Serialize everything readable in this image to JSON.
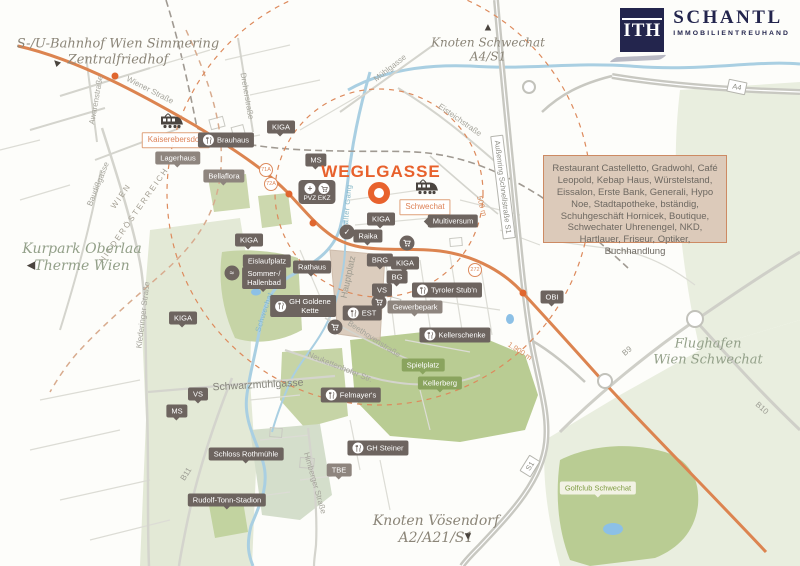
{
  "logo": {
    "mark": "ITH",
    "name": "SCHANTL",
    "subtitle": "IMMOBILIENTREUHAND",
    "brand_color": "#23254d"
  },
  "title_label": {
    "text": "WEGLGASSE",
    "color": "#e8612c"
  },
  "info_box": {
    "text": "Restaurant Castelletto, Gradwohl, Café Leopold, Kebap Haus, Würstelstand, Eissalon, Erste Bank, Generali, Hypo Noe, Stadtapotheke, bständig, Schuhgeschäft Hornicek, Boutique, Schwechater Uhrenengel, NKD, Hartlauer, Friseur, Optiker, Buchhandlung",
    "bg": "#dccaba",
    "border": "#cd8a63"
  },
  "colors": {
    "accent_orange": "#e8612c",
    "road_orange": "#dc8450",
    "badge_dark": "#6d645f",
    "badge_green": "#8aa45e",
    "river_blue": "#a9cfe2",
    "park_green": "#ccd8ae"
  },
  "map": {
    "marker": {
      "x": 379,
      "y": 193
    },
    "area_labels": [
      {
        "name": "label-bahnhof-simmering",
        "lines": [
          "S-/U-Bahnhof Wien Simmering",
          "Zentralfriedhof"
        ],
        "x": 118,
        "y": 52,
        "size": 13,
        "color": "#8b8578",
        "arrow": {
          "dir": "up-left",
          "x": 57,
          "y": 63
        }
      },
      {
        "name": "label-knoten-schwechat",
        "lines": [
          "Knoten Schwechat",
          "A4/S1"
        ],
        "x": 488,
        "y": 50,
        "size": 12,
        "color": "#8b8578",
        "arrow": {
          "dir": "up",
          "x": 488,
          "y": 28
        }
      },
      {
        "name": "label-kurpark-oberlaa",
        "lines": [
          "Kurpark Oberlaa",
          "Therme Wien"
        ],
        "x": 82,
        "y": 258,
        "size": 14,
        "color": "#93a089",
        "arrow": {
          "dir": "left",
          "x": 31,
          "y": 266
        }
      },
      {
        "name": "label-flughafen",
        "lines": [
          "Flughafen",
          "Wien Schwechat"
        ],
        "x": 708,
        "y": 352,
        "size": 13,
        "color": "#93a089"
      },
      {
        "name": "label-knoten-voesendorf",
        "lines": [
          "Knoten Vösendorf",
          "A2/A21/S1"
        ],
        "x": 436,
        "y": 530,
        "size": 14,
        "color": "#8b8578",
        "arrow": {
          "dir": "down",
          "x": 468,
          "y": 537
        }
      }
    ],
    "street_labels": [
      {
        "text": "Wiener Straße",
        "x": 150,
        "y": 90,
        "rot": 27
      },
      {
        "text": "Awarenstraße",
        "x": 96,
        "y": 100,
        "rot": -80
      },
      {
        "text": "Baudißgasse",
        "x": 98,
        "y": 184,
        "rot": -68
      },
      {
        "text": "Dreherstraße",
        "x": 247,
        "y": 96,
        "rot": 80
      },
      {
        "text": "Mühlgasse",
        "x": 390,
        "y": 68,
        "rot": -38
      },
      {
        "text": "Eisteichstraße",
        "x": 460,
        "y": 120,
        "rot": 35
      },
      {
        "text": "Klederinger Straße",
        "x": 143,
        "y": 315,
        "rot": -83
      },
      {
        "text": "Schwarzmühlgasse",
        "x": 258,
        "y": 385,
        "rot": -3,
        "size": 10.5,
        "color": "#84837a"
      },
      {
        "text": "Neukettenhofer Str.",
        "x": 340,
        "y": 367,
        "rot": 22
      },
      {
        "text": "Beethovenstraße",
        "x": 374,
        "y": 339,
        "rot": 33
      },
      {
        "text": "Himberger Straße",
        "x": 315,
        "y": 483,
        "rot": 74
      },
      {
        "text": "Hauptplatz",
        "x": 348,
        "y": 277,
        "rot": -78,
        "size": 9,
        "color": "#9b998e"
      }
    ],
    "water_labels": [
      {
        "name": "river-label-kalter-gang",
        "text": "Kalter Gang",
        "x": 347,
        "y": 207,
        "rot": -85
      },
      {
        "name": "river-label-schwechat",
        "text": "Schwechat",
        "x": 264,
        "y": 312,
        "rot": -72
      }
    ],
    "border_labels": [
      {
        "text": "WIEN",
        "x": 121,
        "y": 196,
        "rot": -55
      },
      {
        "text": "NIEDERÖSTERREICH",
        "x": 134,
        "y": 215,
        "rot": -55
      }
    ],
    "shields": [
      {
        "name": "shield-a4",
        "text": "A4",
        "x": 737,
        "y": 87,
        "rot": 12,
        "boxed": true
      },
      {
        "name": "shield-s1",
        "text": "S1",
        "x": 530,
        "y": 466,
        "rot": -58,
        "boxed": true
      },
      {
        "name": "shield-aussenring-s1",
        "text": "Außenring Schnellstraße S1",
        "x": 503,
        "y": 187,
        "rot": 83,
        "boxed": true
      },
      {
        "name": "road-b9",
        "text": "B9",
        "x": 627,
        "y": 351,
        "rot": -40,
        "boxed": false
      },
      {
        "name": "road-b10",
        "text": "B10",
        "x": 762,
        "y": 408,
        "rot": 42,
        "boxed": false
      },
      {
        "name": "road-b11",
        "text": "B11",
        "x": 186,
        "y": 474,
        "rot": -58,
        "boxed": false
      }
    ],
    "distance_labels": [
      {
        "text": "500 m",
        "x": 482,
        "y": 206,
        "rot": 75
      },
      {
        "text": "1.900 m",
        "x": 520,
        "y": 351,
        "rot": 33
      }
    ],
    "bus_stops": [
      {
        "text": "71A",
        "x": 266,
        "y": 170
      },
      {
        "text": "72A",
        "x": 271,
        "y": 184
      },
      {
        "text": "272",
        "x": 475,
        "y": 270
      }
    ],
    "badges": [
      {
        "name": "badge-kaiserebersdorf",
        "label": "Kaiserebersdorf",
        "type": "orange",
        "x": 176,
        "y": 140
      },
      {
        "name": "badge-schwechat",
        "label": "Schwechat",
        "type": "orange",
        "x": 425,
        "y": 207
      },
      {
        "name": "badge-brauhaus",
        "label": "Brauhaus",
        "type": "dark",
        "icon": "fork",
        "x": 226,
        "y": 140
      },
      {
        "name": "badge-lagerhaus",
        "label": "Lagerhaus",
        "type": "medium",
        "pointer": true,
        "x": 178,
        "y": 158
      },
      {
        "name": "badge-bellaflora",
        "label": "Bellaflora",
        "type": "medium",
        "pointer": true,
        "x": 224,
        "y": 176
      },
      {
        "name": "badge-kiga-1",
        "label": "KIGA",
        "type": "dark",
        "pointer": true,
        "x": 281,
        "y": 127
      },
      {
        "name": "badge-ms-1",
        "label": "MS",
        "type": "dark",
        "pointer": true,
        "x": 316,
        "y": 160
      },
      {
        "name": "badge-pvz-ekz",
        "label": "PVZ EKZ",
        "type": "plaza",
        "x": 317,
        "y": 192
      },
      {
        "name": "badge-kiga-2",
        "label": "KIGA",
        "type": "dark",
        "pointer": true,
        "x": 381,
        "y": 219
      },
      {
        "name": "badge-raika",
        "label": "Raika",
        "type": "dark",
        "pointer": true,
        "x": 368,
        "y": 236
      },
      {
        "name": "badge-multiversum",
        "label": "Multiversum",
        "type": "dark",
        "arrowLeft": true,
        "x": 453,
        "y": 221
      },
      {
        "name": "badge-kiga-3",
        "label": "KIGA",
        "type": "dark",
        "pointer": true,
        "x": 249,
        "y": 240
      },
      {
        "name": "badge-eislaufplatz",
        "label": "Eislaufplatz",
        "type": "dark",
        "pointer": true,
        "x": 267,
        "y": 261
      },
      {
        "name": "badge-sommer-hallenbad",
        "lines": [
          "Sommer-/",
          "Hallenbad"
        ],
        "type": "dark",
        "pointer": true,
        "x": 264,
        "y": 278
      },
      {
        "name": "badge-rathaus",
        "label": "Rathaus",
        "type": "dark",
        "pointer": true,
        "x": 312,
        "y": 267
      },
      {
        "name": "badge-gh-goldene-kette",
        "lines": [
          "GH Goldene",
          "Kette"
        ],
        "type": "dark",
        "icon": "fork",
        "x": 303,
        "y": 306
      },
      {
        "name": "badge-kiga-4",
        "label": "KIGA",
        "type": "dark",
        "pointer": true,
        "x": 183,
        "y": 318
      },
      {
        "name": "badge-brg",
        "label": "BRG",
        "type": "dark",
        "pointer": true,
        "x": 380,
        "y": 260
      },
      {
        "name": "badge-kiga-5",
        "label": "KIGA",
        "type": "dark",
        "pointer": true,
        "x": 405,
        "y": 263
      },
      {
        "name": "badge-bg",
        "label": "BG",
        "type": "dark",
        "pointer": true,
        "x": 397,
        "y": 277
      },
      {
        "name": "badge-vs-1",
        "label": "VS",
        "type": "dark",
        "pointer": true,
        "x": 382,
        "y": 290
      },
      {
        "name": "badge-tyroler-stubn",
        "label": "Tyroler Stub'n",
        "type": "dark",
        "icon": "fork",
        "x": 447,
        "y": 290
      },
      {
        "name": "badge-gewerbepark",
        "label": "Gewerbepark",
        "type": "medium",
        "pointer": true,
        "x": 415,
        "y": 307
      },
      {
        "name": "badge-est",
        "label": "EST",
        "type": "dark",
        "icon": "fork",
        "x": 362,
        "y": 313
      },
      {
        "name": "badge-kellerschenke",
        "label": "Kellerschenke",
        "type": "dark",
        "icon": "fork",
        "x": 455,
        "y": 335
      },
      {
        "name": "badge-spielplatz",
        "label": "Spielplatz",
        "type": "green",
        "pointer": true,
        "x": 423,
        "y": 365
      },
      {
        "name": "badge-kellerberg",
        "label": "Kellerberg",
        "type": "green",
        "pointer": true,
        "x": 440,
        "y": 383
      },
      {
        "name": "badge-felmayers",
        "label": "Felmayer's",
        "type": "dark",
        "icon": "fork",
        "x": 351,
        "y": 395
      },
      {
        "name": "badge-gh-steiner",
        "label": "GH Steiner",
        "type": "dark",
        "icon": "fork",
        "x": 378,
        "y": 448
      },
      {
        "name": "badge-vs-2",
        "label": "VS",
        "type": "dark",
        "pointer": true,
        "x": 198,
        "y": 394
      },
      {
        "name": "badge-ms-2",
        "label": "MS",
        "type": "dark",
        "pointer": true,
        "x": 177,
        "y": 411
      },
      {
        "name": "badge-schloss-rothmuehle",
        "label": "Schloss Rothmühle",
        "type": "dark",
        "pointer": true,
        "x": 246,
        "y": 454
      },
      {
        "name": "badge-rudolf-tonn-stadion",
        "label": "Rudolf-Tonn-Stadion",
        "type": "dark",
        "pointer": true,
        "x": 227,
        "y": 500
      },
      {
        "name": "badge-tbe",
        "label": "TBE",
        "type": "medium",
        "pointer": true,
        "x": 339,
        "y": 470
      },
      {
        "name": "badge-obi",
        "label": "OBI",
        "type": "dark",
        "pointer": true,
        "x": 552,
        "y": 297
      },
      {
        "name": "badge-golfclub-schwechat",
        "label": "Golfclub Schwechat",
        "type": "light",
        "pointer": true,
        "x": 598,
        "y": 488
      }
    ],
    "poi_icons": [
      {
        "icon": "swim",
        "x": 232,
        "y": 273
      },
      {
        "icon": "check",
        "x": 347,
        "y": 232
      },
      {
        "icon": "cart",
        "x": 379,
        "y": 302
      },
      {
        "icon": "cart",
        "x": 335,
        "y": 327
      },
      {
        "icon": "cart",
        "x": 407,
        "y": 243
      }
    ],
    "train_stations": [
      {
        "name": "train-station-kaiserebersdorf",
        "x": 172,
        "y": 121
      },
      {
        "name": "train-station-schwechat",
        "x": 427,
        "y": 187
      }
    ]
  }
}
